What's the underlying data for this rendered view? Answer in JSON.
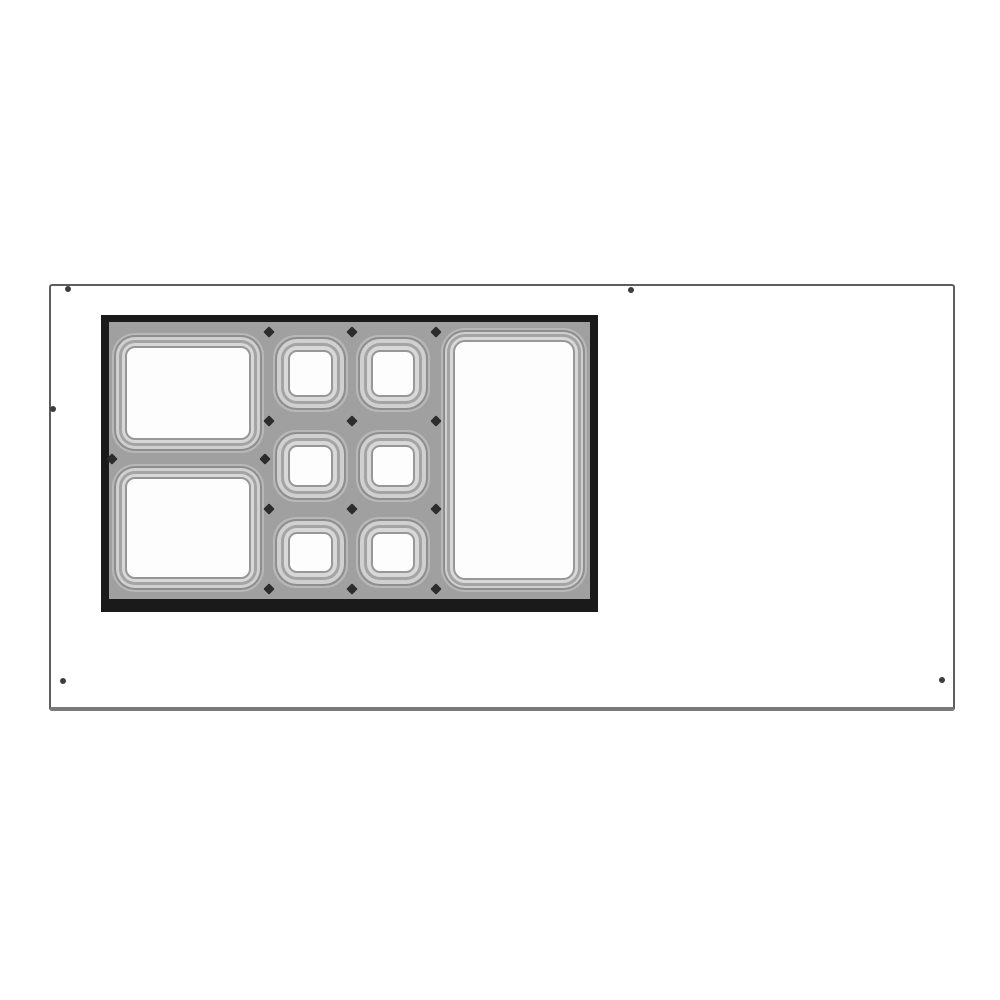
{
  "page": {
    "background": "#ffffff",
    "description": "Technical line drawing: top view of an equipment countertop with a recessed adapter section holding nine food-pan openings (two large pans, six small pans in a 2x3 grid, one tall pan)"
  },
  "countertop": {
    "x": 49,
    "y": 284,
    "width": 906,
    "height": 427,
    "stroke_color": "#5e5e5e",
    "border_top": 2,
    "border_right": 2,
    "border_bottom": 4,
    "border_left": 2,
    "bottom_edge_color": "#7a7a7a"
  },
  "screw_holes": {
    "color": "#3d3d3d",
    "diameter": 6,
    "positions": [
      {
        "x": 68,
        "y": 289
      },
      {
        "x": 631,
        "y": 290
      },
      {
        "x": 53,
        "y": 409
      },
      {
        "x": 63,
        "y": 681
      },
      {
        "x": 942,
        "y": 680
      }
    ]
  },
  "pan_assembly": {
    "x": 101,
    "y": 315,
    "width": 497,
    "height": 297,
    "frame_color": "#1a1a1a",
    "deck_color": "#a0a0a0",
    "frame_top": 7,
    "frame_right": 8,
    "frame_bottom": 13,
    "frame_left": 8,
    "pans": [
      {
        "name": "pan-large-top-left",
        "x": 3,
        "y": 11,
        "width": 152,
        "height": 120,
        "inset": 13,
        "radius": 10
      },
      {
        "name": "pan-large-bottom-left",
        "x": 3,
        "y": 142,
        "width": 152,
        "height": 128,
        "inset": 13,
        "radius": 10
      },
      {
        "name": "pan-small-row1-col1",
        "x": 164,
        "y": 13,
        "width": 75,
        "height": 77,
        "inset": 15,
        "radius": 9
      },
      {
        "name": "pan-small-row1-col2",
        "x": 247,
        "y": 13,
        "width": 74,
        "height": 77,
        "inset": 15,
        "radius": 9
      },
      {
        "name": "pan-small-row2-col1",
        "x": 164,
        "y": 108,
        "width": 75,
        "height": 72,
        "inset": 15,
        "radius": 9
      },
      {
        "name": "pan-small-row2-col2",
        "x": 247,
        "y": 108,
        "width": 74,
        "height": 72,
        "inset": 15,
        "radius": 9
      },
      {
        "name": "pan-small-row3-col1",
        "x": 164,
        "y": 195,
        "width": 75,
        "height": 71,
        "inset": 15,
        "radius": 9
      },
      {
        "name": "pan-small-row3-col2",
        "x": 247,
        "y": 195,
        "width": 74,
        "height": 71,
        "inset": 15,
        "radius": 9
      },
      {
        "name": "pan-large-right",
        "x": 332,
        "y": 6,
        "width": 146,
        "height": 264,
        "inset": 12,
        "radius": 12
      }
    ],
    "junction_marks": {
      "color": "#2c2c2c",
      "size": 8,
      "positions": [
        {
          "x": 160,
          "y": 10
        },
        {
          "x": 243,
          "y": 10
        },
        {
          "x": 327,
          "y": 10
        },
        {
          "x": 160,
          "y": 99
        },
        {
          "x": 243,
          "y": 99
        },
        {
          "x": 327,
          "y": 99
        },
        {
          "x": 160,
          "y": 187
        },
        {
          "x": 243,
          "y": 187
        },
        {
          "x": 327,
          "y": 187
        },
        {
          "x": 160,
          "y": 267
        },
        {
          "x": 243,
          "y": 267
        },
        {
          "x": 327,
          "y": 267
        },
        {
          "x": 3,
          "y": 137
        },
        {
          "x": 156,
          "y": 137
        }
      ]
    }
  }
}
